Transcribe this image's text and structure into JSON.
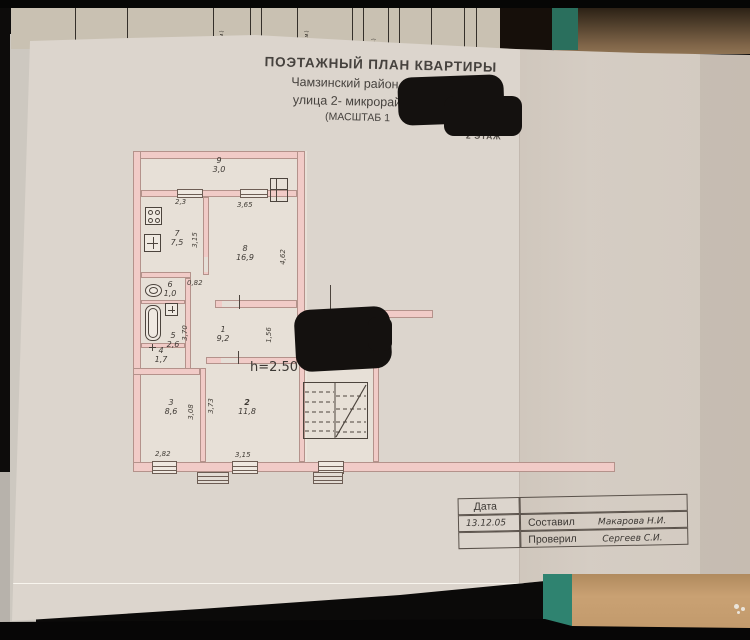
{
  "background_document": {
    "fragments": [
      "(кв.м.)",
      "(кв.м.)",
      "м.)"
    ]
  },
  "title_block": {
    "title": "ПОЭТАЖНЫЙ ПЛАН КВАРТИРЫ",
    "address_line1": "Чамзинский район,р.п. К",
    "address_line2": "улица 2- микрорайон",
    "scale_line": "(МАСШТАБ  1",
    "floor_label": "2 ЭТАЖ"
  },
  "plan": {
    "height_note": "h=2.50",
    "rooms": [
      {
        "number": "1",
        "area": "9,2"
      },
      {
        "number": "2",
        "area": "11,8"
      },
      {
        "number": "3",
        "area": "8,6"
      },
      {
        "number": "4",
        "area": "1,7"
      },
      {
        "number": "5",
        "area": "2,6"
      },
      {
        "number": "6",
        "area": "1,0"
      },
      {
        "number": "7",
        "area": "7,5"
      },
      {
        "number": "8",
        "area": "16,9"
      },
      {
        "number": "9",
        "area": "3,0"
      }
    ],
    "dimensions": {
      "kitchen_top": "2,3",
      "kitchen_side": "3,15",
      "room8_top": "3,65",
      "room8_side": "4,62",
      "lobby_width": "0,82",
      "bath_side": "3,70",
      "hall_side": "1,56",
      "room3_bottom": "2,82",
      "room3_side": "3,08",
      "room2_bottom": "3,15",
      "room2_side": "3,73"
    }
  },
  "stamp_table": {
    "date_label": "Дата",
    "date_value": "13.12.05",
    "compiled_label": "Составил",
    "compiled_by": "Макарова Н.И.",
    "checked_label": "Проверил",
    "checked_by": "Сергеев С.И."
  },
  "colors": {
    "wall_pink": "#f1cbc7",
    "paper": "#dcd5cd",
    "line": "#4c443d",
    "teal_folder": "#2f8370",
    "wood_table": "#c9a173",
    "redaction_black": "#14110f"
  }
}
